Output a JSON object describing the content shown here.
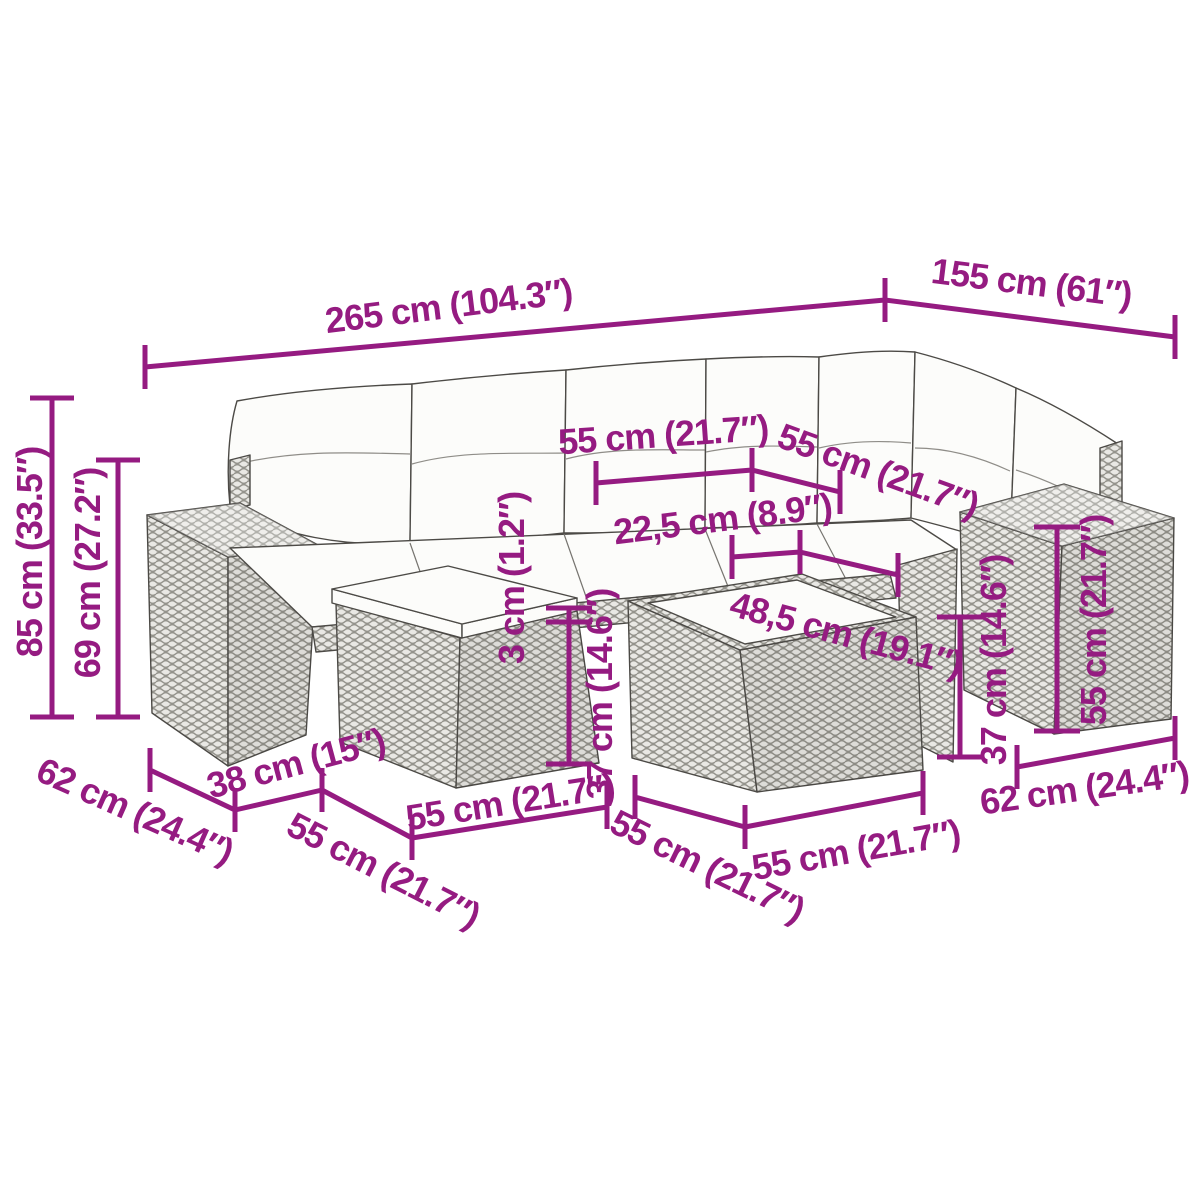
{
  "colors": {
    "accent": "#951b81",
    "drawing_outline": "#4c4a46",
    "background": "#ffffff"
  },
  "figure": {
    "type": "product-dimension-diagram",
    "subject": "poly-rattan garden lounge set: corner sofa with back cushions, two armrests, footstool and table"
  },
  "annotations": {
    "overall_width": "265 cm (104.3″)",
    "right_section_depth": "155 cm (61″)",
    "total_height": "85 cm (33.5″)",
    "backrest_height": "69 cm (27.2″)",
    "seat_width": "55 cm (21.7″)",
    "right_seat_width": "55 cm (21.7″)",
    "seat_to_table_gap": "22,5 cm (8.9″)",
    "tabletop_width": "48,5 cm (19.1″)",
    "cushion_thickness": "3 cm (1.2″)",
    "footstool_height": "37 cm (14.6″)",
    "right_base_height": "37 cm (14.6″)",
    "armrest_height": "55 cm (21.7″)",
    "left_armrest_depth": "62 cm (24.4″)",
    "armrest_width": "38 cm (15″)",
    "footstool_depth": "55 cm (21.7″)",
    "footstool_width": "55 cm (21.7″)",
    "table_depth": "55 cm (21.7″)",
    "table_width": "55 cm (21.7″)",
    "right_armrest_depth": "62 cm (24.4″)"
  }
}
